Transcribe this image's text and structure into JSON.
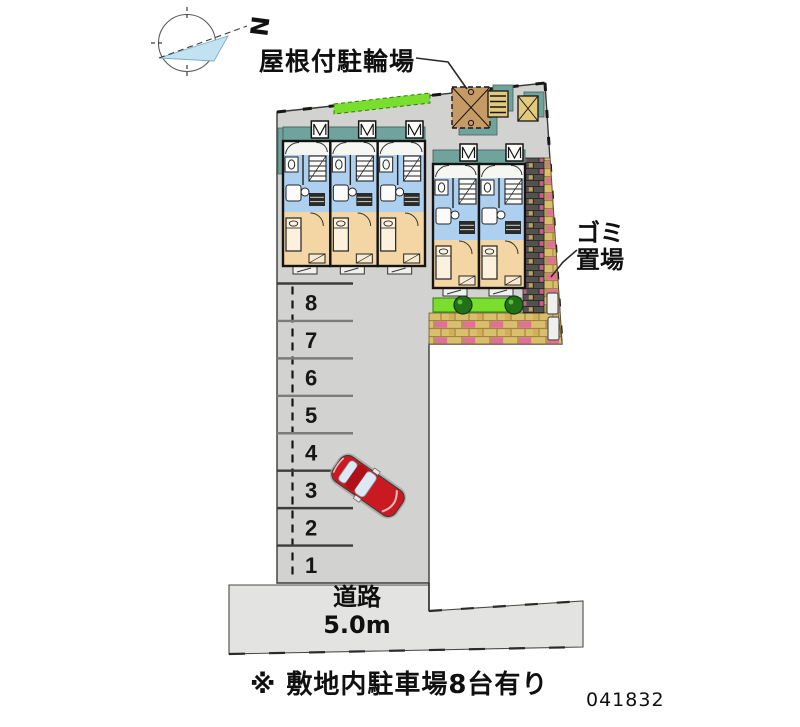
{
  "compass": {
    "north_letter": "N"
  },
  "labels": {
    "bicycle_parking": "屋根付駐輪場",
    "garbage": "ゴミ\n置場",
    "road": "道路\n5.0m",
    "note": "※ 敷地内駐車場8台有り",
    "plan_id": "041832"
  },
  "parking": {
    "space_numbers": [
      "8",
      "7",
      "6",
      "5",
      "4",
      "3",
      "2",
      "1"
    ],
    "total_spaces": 8
  },
  "building": {
    "left_unit_count": 3,
    "right_unit_count": 2
  },
  "colors": {
    "site_fill": "#d2d2d0",
    "road_fill": "#e3e3e1",
    "roof_teal": "#6fa39b",
    "room_blue": "#aed0f0",
    "room_tan": "#f4d5a4",
    "room_white": "#f6f6f3",
    "grass_green": "#7ade2e",
    "tree_green": "#227018",
    "brick_yellow": "#d9bf6b",
    "brick_pink": "#e0689a",
    "wall_dark": "#54524e",
    "shed_brown": "#c69a64",
    "box_yellow": "#e3c97e",
    "car_red": "#c81a20",
    "compass_blue": "#c2e2f2",
    "line": "#1a1a1a"
  }
}
